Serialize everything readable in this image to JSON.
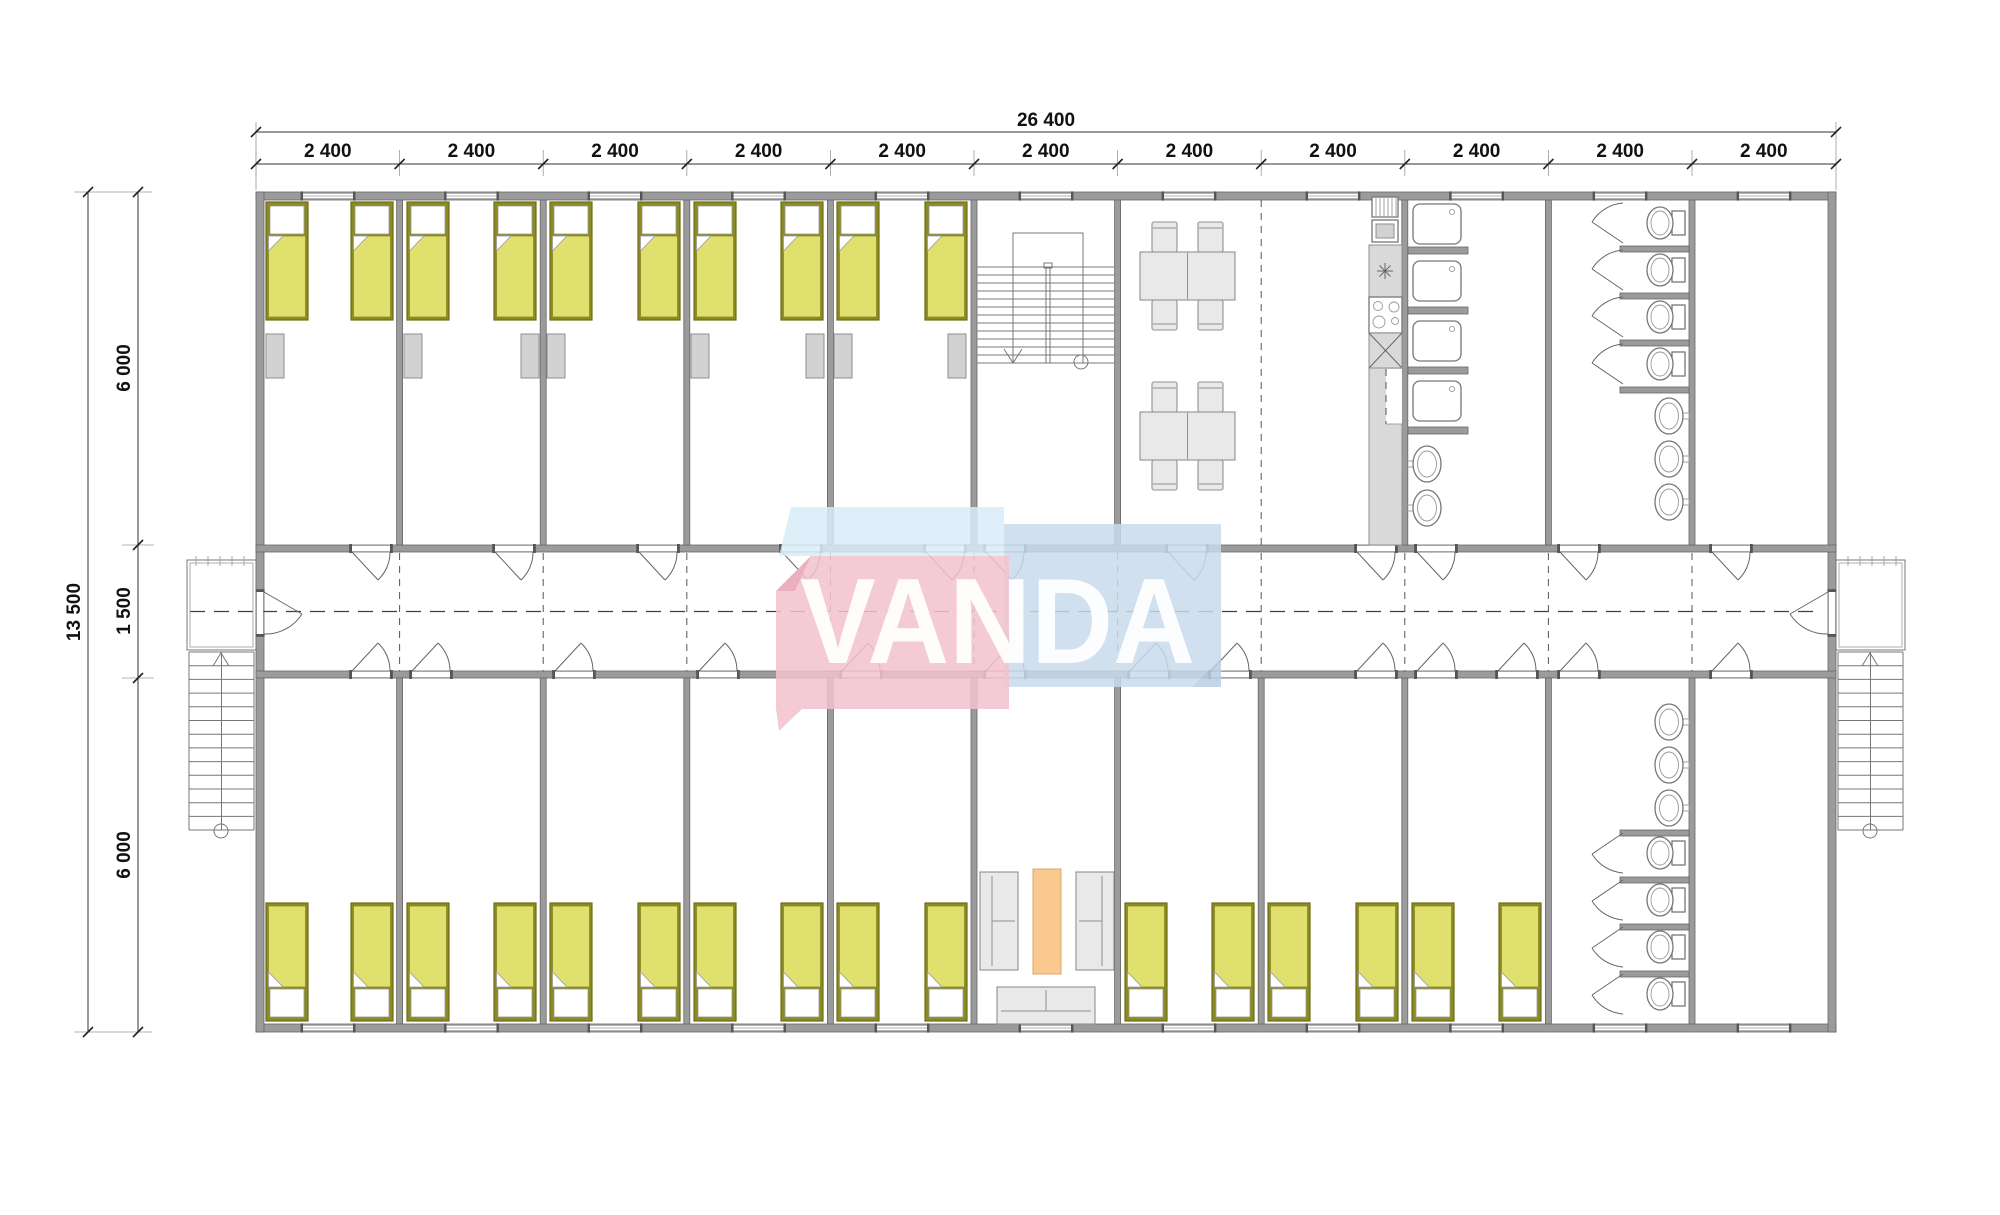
{
  "page": {
    "background": "#ffffff"
  },
  "watermark": {
    "text": "VANDA"
  },
  "dimensions": {
    "total_width_label": "26 400",
    "module_width_label": "2 400",
    "module_count": 11,
    "total_height_label": "13 500",
    "upper_band_label": "6 000",
    "corridor_label": "1 500",
    "lower_band_label": "6 000"
  },
  "colors": {
    "wall": "#9b9b9b",
    "wall_edge": "#666666",
    "line": "#777777",
    "text": "#111111",
    "bed_frame": "#8b8a24",
    "bed_blanket": "#e0e06e",
    "pillow": "#ffffff",
    "cabinet": "#d2d2d2",
    "furniture_fill": "#e9e9e9",
    "furniture_edge": "#8f8f8f",
    "counter": "#d9d9d9",
    "table_orange": "#f9c98f",
    "wm_pink": "#f2c3cd",
    "wm_pink_dark": "#e9a9b8",
    "wm_blue": "#c9dbeb",
    "wm_blue_dark": "#b9cfe4",
    "wm_lightblue": "#d8ecf8",
    "wm_text": "#ffffff"
  }
}
